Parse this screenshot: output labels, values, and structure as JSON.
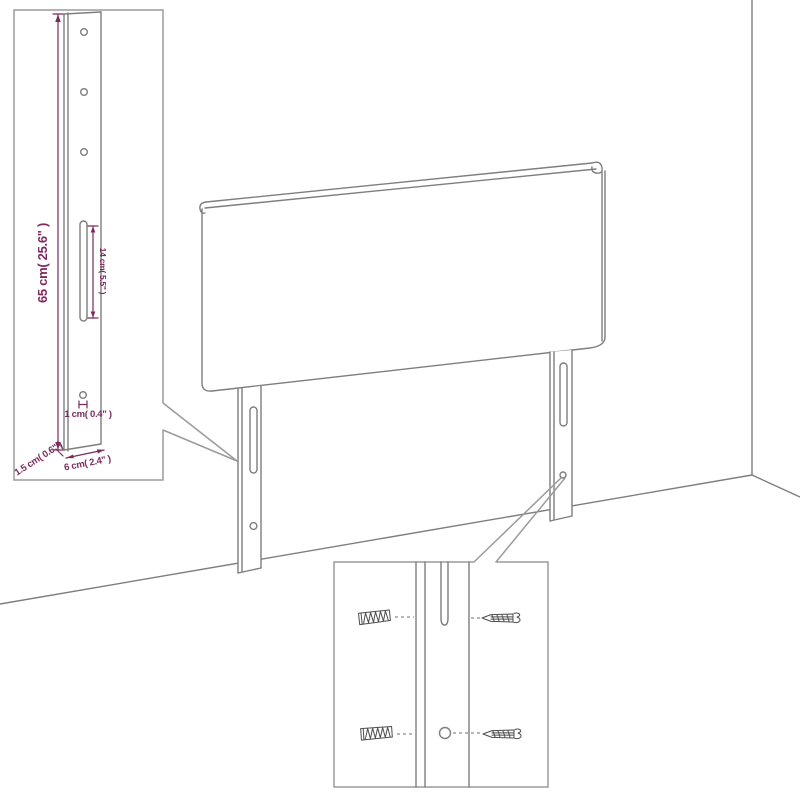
{
  "diagram": {
    "type": "furniture-dimension-diagram",
    "subject": "upholstered headboard with two slotted mounting legs shown against a wall corner"
  },
  "colors": {
    "background": "#ffffff",
    "drawing_line_gray": "#7e7e7e",
    "callout_border_gray": "#9b9b9b",
    "dimension_magenta": "#7d2b5c",
    "hardware_dark_gray": "#4d4d4d"
  },
  "leg_detail_callout": {
    "dimensions": {
      "height_label": "65 cm( 25.6\" )",
      "slot_length_label": "14 cm( 5.5\" )",
      "hole_diameter_label": "1 cm( 0.4\" )",
      "depth_label": "1.5 cm( 0.6\" )",
      "width_label": "6 cm( 2.4\" )"
    },
    "mounting_hole_count": 3,
    "slot_count": 1
  },
  "mounting_detail_callout": {
    "wall_plug_count": 2,
    "screw_count": 2,
    "hole_count": 1
  }
}
